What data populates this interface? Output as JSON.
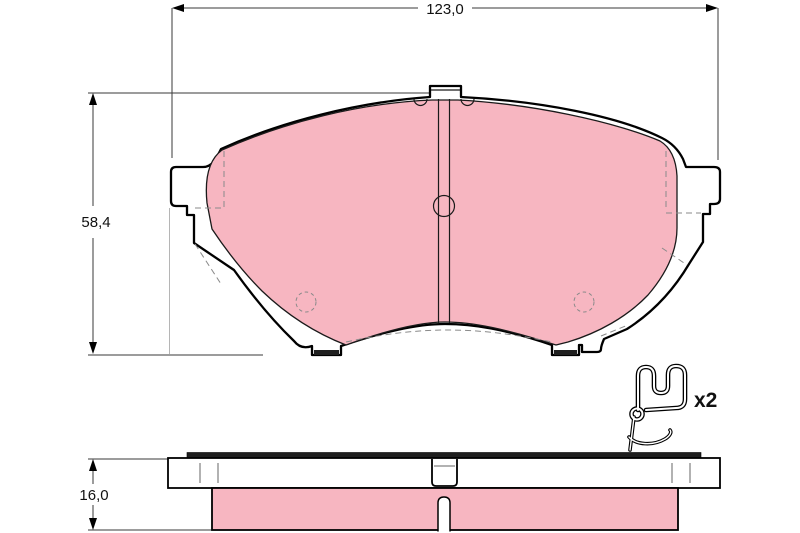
{
  "drawing": {
    "dimensions": {
      "overall_width": "123,0",
      "overall_height": "58,4",
      "thickness": "16,0"
    },
    "accessory": {
      "quantity": "x2"
    },
    "colors": {
      "friction_material": "#f7b6c1",
      "outline": "#000000",
      "dimension_line": "#3a3a3a",
      "hidden_line": "#8a8a8a",
      "shim": "#1f1f1f",
      "background": "#ffffff"
    }
  }
}
